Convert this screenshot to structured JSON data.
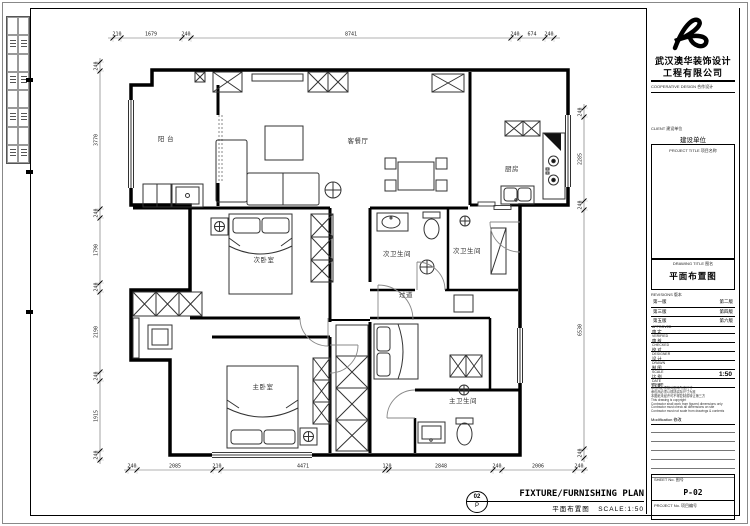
{
  "company": {
    "name_line1": "武汉澳华装饰设计",
    "name_line2": "工程有限公司"
  },
  "title_block": {
    "cooperative_caption": "COOPERATIVE DESIGN  合作设计",
    "client_caption": "CLIENT  建设单位",
    "client_value": "建设单位",
    "project_caption": "PROJECT TITLE  项目名称",
    "drawing_caption": "DRAWING TITLE  图名",
    "drawing_value": "平面布置图",
    "revisions_caption": "REVISIONS  版本",
    "revision_rows": [
      "第一版",
      "第二版",
      "第三版",
      "第四版",
      "第五版",
      "第六版"
    ],
    "roles": [
      {
        "en": "APPROVED",
        "zh": "审 定"
      },
      {
        "en": "VERIFIED",
        "zh": "审 核"
      },
      {
        "en": "CHECKED",
        "zh": "校 对"
      },
      {
        "en": "DESIGNER",
        "zh": "设 计"
      },
      {
        "en": "DRAWN",
        "zh": "制 图"
      }
    ],
    "scale_row": {
      "en": "SCALE",
      "zh": "比 例",
      "value": "1:50"
    },
    "date_row": {
      "en": "DATE",
      "zh": "日 期"
    },
    "notes": [
      "版权所有",
      "承包商必须核对图中所注尺寸",
      "承包商必须以现场实际尺寸为准",
      "本图纸未经许可不得复制或转让第三方",
      "This drawing is copyright",
      "Contractor shall work from figured dimensions only",
      "Contractor must check all dimensions on site",
      "Contractor must not scale from drawings & contents"
    ],
    "modification_caption": "Modification  修改",
    "sheet_caption": "SHEET No.  图号",
    "sheet_value": "P-02",
    "project_no_caption": "PROJECT No.  项目编号"
  },
  "footer": {
    "detail_number": "02",
    "detail_letter": "P",
    "title_en": "FIXTURE/FURNISHING PLAN",
    "title_zh": "平面布置图",
    "scale_label": "SCALE:1:50"
  },
  "plan": {
    "room_labels": [
      {
        "t": "阳  台",
        "x": 166,
        "y": 141
      },
      {
        "t": "客餐厅",
        "x": 358,
        "y": 143
      },
      {
        "t": "厨房",
        "x": 512,
        "y": 171
      },
      {
        "t": "次卧室",
        "x": 264,
        "y": 262
      },
      {
        "t": "次卫生间",
        "x": 397,
        "y": 256
      },
      {
        "t": "次卫生间",
        "x": 467,
        "y": 253
      },
      {
        "t": "过道",
        "x": 406,
        "y": 297
      },
      {
        "t": "主卧室",
        "x": 263,
        "y": 389
      },
      {
        "t": "主卫生间",
        "x": 463,
        "y": 403
      }
    ],
    "dimensions": [
      {
        "name": "top",
        "orient": "h",
        "line": {
          "x1": 108,
          "x2": 560,
          "y": 38
        },
        "ticks": [
          113,
          121,
          182,
          191,
          511,
          520,
          545,
          554
        ],
        "labels": [
          {
            "p": 117,
            "t": "210"
          },
          {
            "p": 151,
            "t": "1679"
          },
          {
            "p": 186,
            "t": "240"
          },
          {
            "p": 351,
            "t": "8741"
          },
          {
            "p": 515,
            "t": "240"
          },
          {
            "p": 532,
            "t": "674"
          },
          {
            "p": 549,
            "t": "240"
          }
        ]
      },
      {
        "name": "bottom",
        "orient": "h",
        "line": {
          "x1": 124,
          "x2": 588,
          "y": 470
        },
        "ticks": [
          128,
          137,
          213,
          221,
          385,
          389,
          493,
          502,
          575,
          584
        ],
        "labels": [
          {
            "p": 132,
            "t": "240"
          },
          {
            "p": 175,
            "t": "2085"
          },
          {
            "p": 217,
            "t": "210"
          },
          {
            "p": 303,
            "t": "4471"
          },
          {
            "p": 387,
            "t": "120"
          },
          {
            "p": 441,
            "t": "2848"
          },
          {
            "p": 497,
            "t": "240"
          },
          {
            "p": 538,
            "t": "2006"
          },
          {
            "p": 579,
            "t": "240"
          }
        ]
      },
      {
        "name": "left",
        "orient": "v",
        "line": {
          "y1": 58,
          "y2": 464,
          "x": 100
        },
        "ticks": [
          62,
          71,
          209,
          218,
          283,
          292,
          372,
          381,
          451,
          460
        ],
        "labels": [
          {
            "p": 66,
            "t": "240"
          },
          {
            "p": 140,
            "t": "3770"
          },
          {
            "p": 213,
            "t": "240"
          },
          {
            "p": 250,
            "t": "1790"
          },
          {
            "p": 287,
            "t": "240"
          },
          {
            "p": 332,
            "t": "2190"
          },
          {
            "p": 376,
            "t": "240"
          },
          {
            "p": 416,
            "t": "1915"
          },
          {
            "p": 455,
            "t": "240"
          }
        ]
      },
      {
        "name": "right",
        "orient": "v",
        "line": {
          "y1": 104,
          "y2": 462,
          "x": 584
        },
        "ticks": [
          108,
          117,
          201,
          210,
          449,
          458
        ],
        "labels": [
          {
            "p": 112,
            "t": "240"
          },
          {
            "p": 159,
            "t": "2285"
          },
          {
            "p": 205,
            "t": "240"
          },
          {
            "p": 330,
            "t": "6530"
          },
          {
            "p": 453,
            "t": "240"
          }
        ]
      }
    ]
  }
}
